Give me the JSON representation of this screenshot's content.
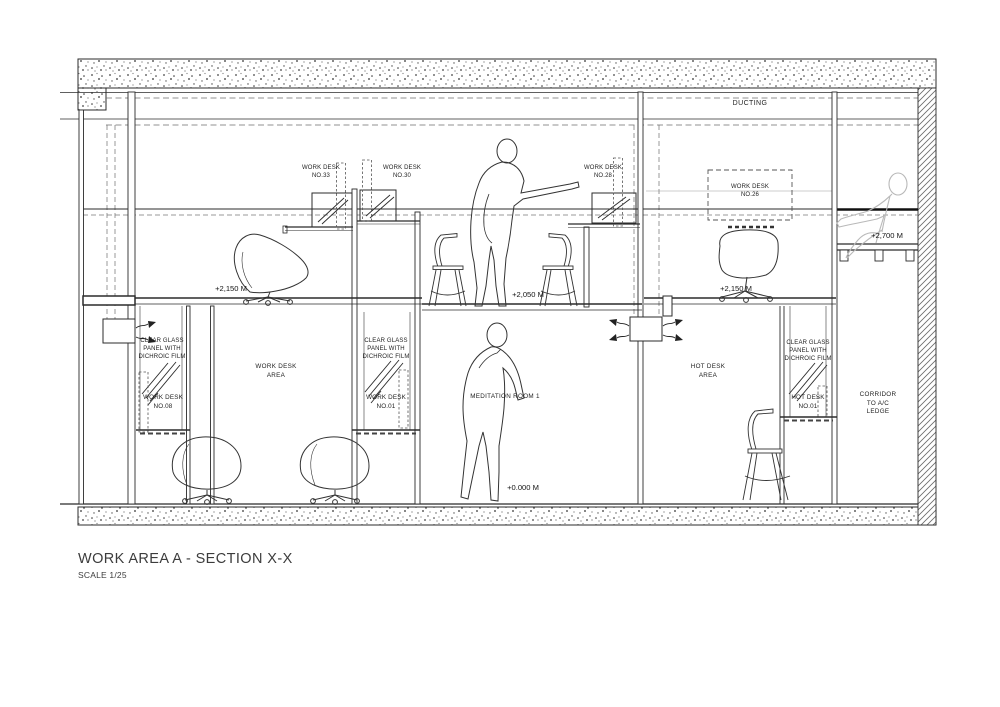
{
  "title_block": {
    "title": "WORK AREA A - SECTION X-X",
    "scale": "SCALE 1/25"
  },
  "zones": {
    "ducting": "DUCTING",
    "work_desk_area": "WORK DESK\nAREA",
    "meditation_room": "MEDITATION ROOM 1",
    "hot_desk_area": "HOT DESK\nAREA",
    "corridor": "CORRIDOR\nTO A/C\nLEDGE"
  },
  "desks": {
    "no_33": "WORK DESK\nNO.33",
    "no_30": "WORK DESK\nNO.30",
    "no_28": "WORK DESK\nNO.28",
    "no_26": "WORK DESK\nNO.26",
    "no_08": "WORK DESK\nNO.08",
    "no_01": "WORK DESK\nNO.01",
    "hot_01": "HOT DESK\nNO.01"
  },
  "annotations": {
    "glass_panel_note": "CLEAR GLASS\nPANEL WITH\nDICHROIC FILM"
  },
  "levels": {
    "upper_floor_left": "+2,150 M",
    "upper_floor_middle": "+2,050 M",
    "upper_floor_right": "+2,150 M",
    "ac_ledge": "+2,700 M",
    "ground": "+0.000 M"
  },
  "colors": {
    "line": "#2b2b2b",
    "light_line": "#8a8a8a",
    "ghost_figure": "#b9b9b9",
    "paper": "#ffffff"
  }
}
